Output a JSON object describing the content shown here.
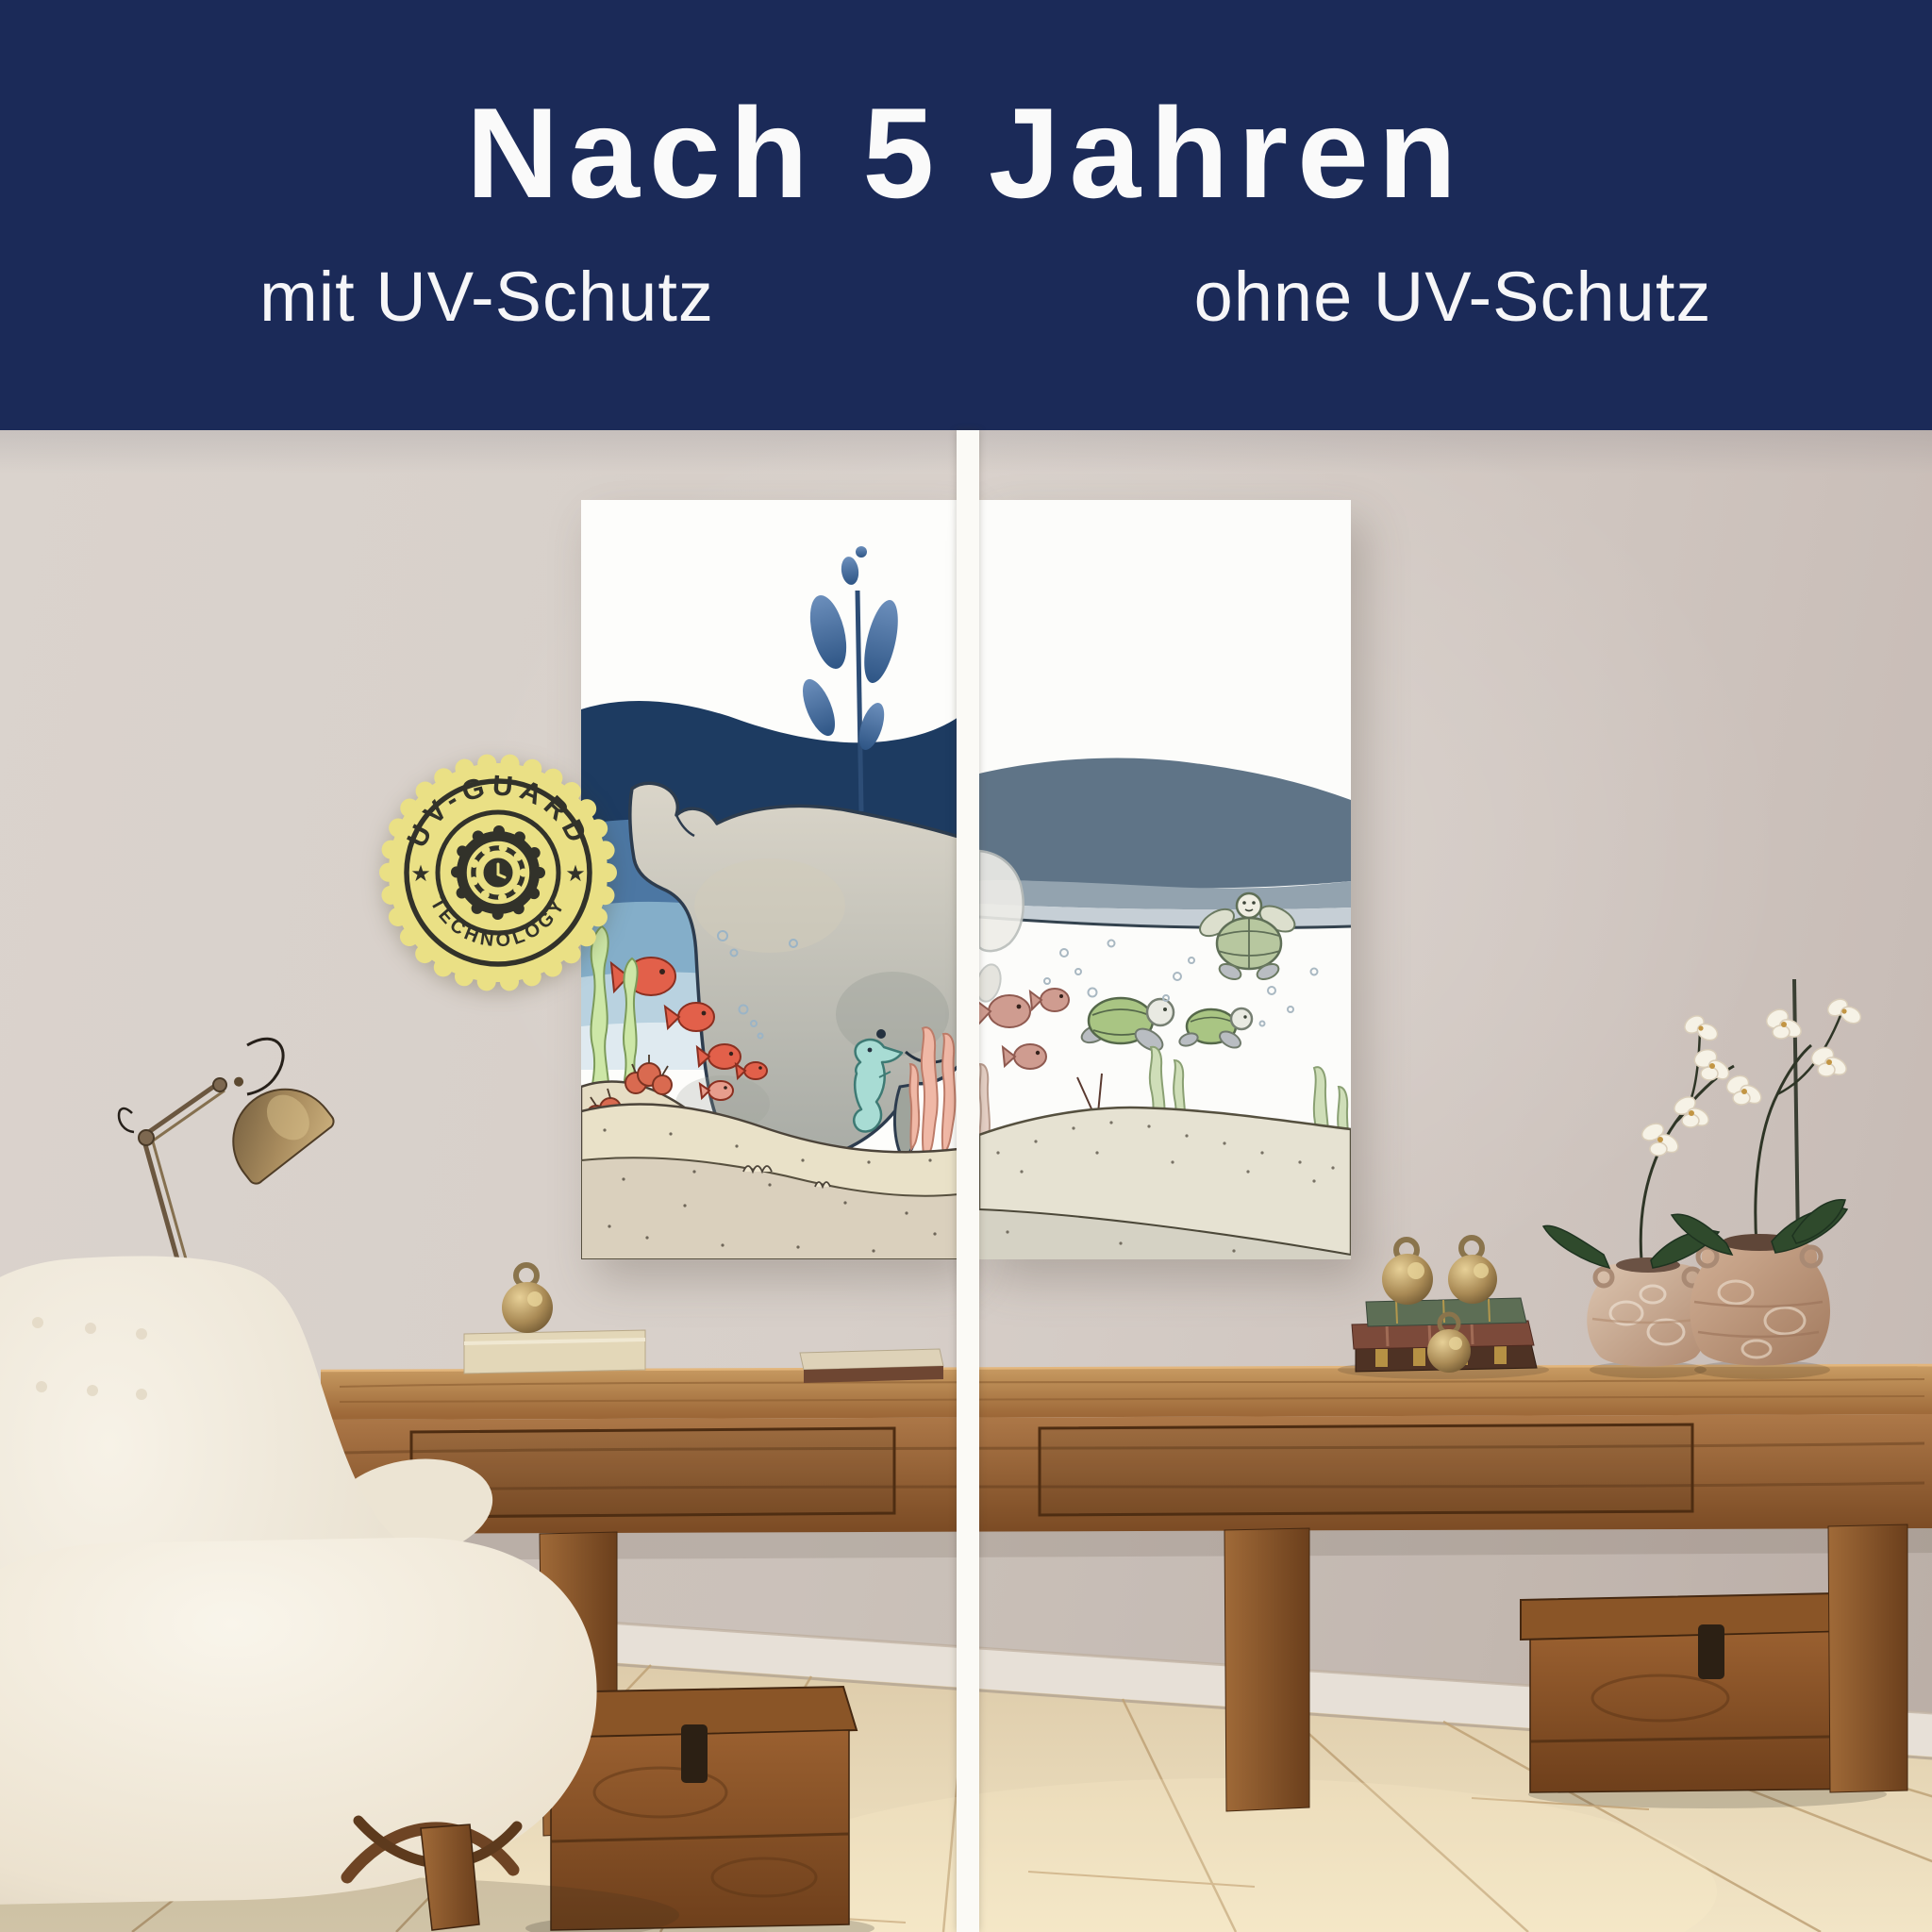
{
  "header": {
    "title": "Nach 5 Jahren",
    "label_left": "mit UV-Schutz",
    "label_right": "ohne UV-Schutz"
  },
  "badge": {
    "arc_top": "UV-GUARD",
    "arc_bottom": "TECHNOLOGY",
    "star_left": "★",
    "star_right": "★"
  },
  "colors": {
    "header_navy": "#1b2a58",
    "text_white": "#fafafa",
    "badge_gold": "#eae085",
    "badge_ink": "#32322a",
    "divider_white": "#fbfaf6",
    "wall_greige": "#d5ccc6",
    "floor_oak": "#e9dcc0",
    "table_wood": "#9c6737",
    "mural_navy": "#1d3b61",
    "mural_faded_blue": "#5f7487",
    "fish_coral": "#e2604a",
    "fish_faded": "#cf9c90",
    "turtle_green": "#a9c583",
    "seahorse_teal": "#a8dcd4",
    "lobster_red": "#bd7765"
  }
}
